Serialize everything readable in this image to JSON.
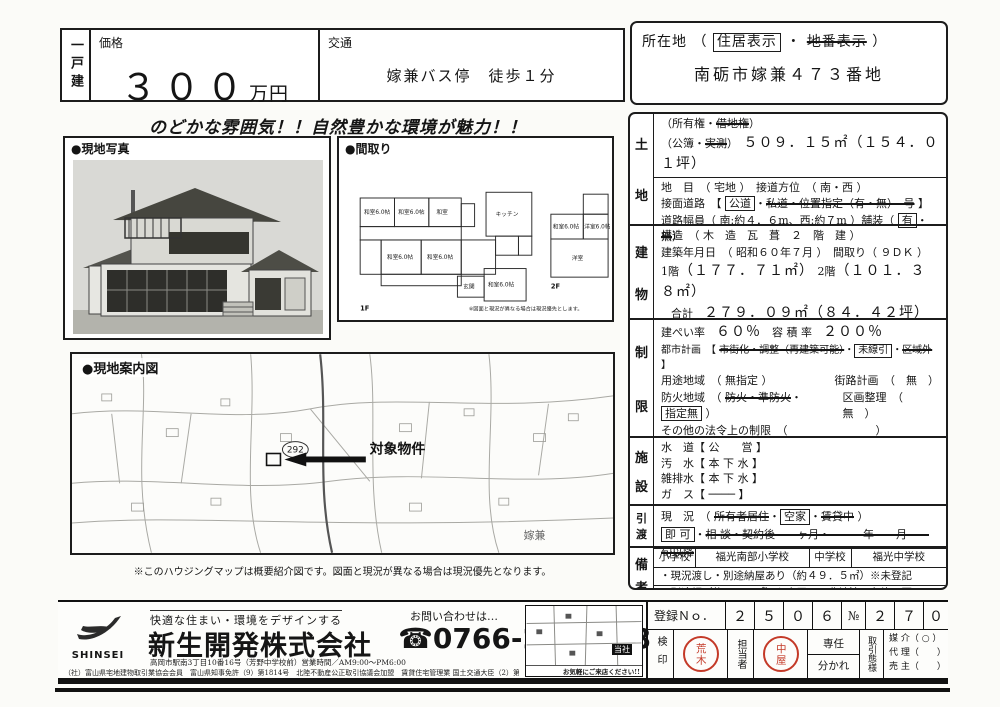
{
  "header": {
    "category": "一戸建",
    "price": {
      "label": "価格",
      "value": "３００",
      "unit": "万円"
    },
    "transport": {
      "label": "交通",
      "value": "嫁兼バス停　徒歩１分"
    },
    "location": {
      "label": "所在地",
      "paren_open": "（",
      "opt_boxed": "住居表示",
      "dot": "・",
      "opt_struck": "地番表示",
      "paren_close": "）",
      "address": "南砺市嫁兼４７３番地"
    }
  },
  "catchphrase": "のどかな雰囲気！！自然豊かな環境が魅力！！",
  "photo": {
    "label": "●現地写真"
  },
  "floorplan": {
    "label": "●間取り",
    "floor1": "1F",
    "floor2": "2F",
    "rooms1": [
      "和室6.0帖",
      "和室6.0帖",
      "和室",
      "キッチン",
      "和室6.0帖",
      "和室6.0帖",
      "玄関",
      "和室6.0帖"
    ],
    "rooms2": [
      "和室6.0帖",
      "洋室6.0帖",
      "洋室"
    ],
    "note": "※図面と現況が異なる場合は現況優先とします。"
  },
  "map": {
    "label": "●現地案内図",
    "route_badge": "292",
    "target_label": "対象物件",
    "area_label": "嫁兼",
    "note": "※このハウジングマップは概要紹介図です。図面と現況が異なる場合は現況優先となります。"
  },
  "land": {
    "h1": "土",
    "h2": "地",
    "ownership_pre": "（所有権・",
    "ownership_struck": "借地権",
    "ownership_post": "）",
    "area_pre": "（公簿・",
    "area_struck": "実測",
    "area_post": "）",
    "area_value": "５０９．１５㎡（１５４．０１坪）",
    "chimoku": "地　目　（ 宅地 ）",
    "setsudo": "接道方位　（ 南・西 ）",
    "road_label": "接面道路　【",
    "road_boxed": "公道",
    "road_dot": "・",
    "road_struck": "私道・位置指定（有・無）　号",
    "road_close": "】",
    "width_pre": "道路幅員（ 南:約４．６m、西:約７m ）舗装（",
    "width_boxed": "有",
    "width_dot": "・",
    "width_struck": "無",
    "width_close": "）"
  },
  "building": {
    "h1": "建",
    "h2": "物",
    "structure": "構造　（ 木　造　瓦　葺　２　階　建 ）",
    "built": "建築年月日　（ 昭和６０年７月 ）　間取り（ ９ＤＫ ）",
    "f1_label": "1階",
    "f1": "（１７７．７１㎡）",
    "f2_label": "2階",
    "f2": "（１０１．３８㎡）",
    "total_label": "合計",
    "total": "２７９．０９㎡（８４．４２坪）"
  },
  "restrictions": {
    "h1": "制",
    "h2": "限",
    "kenpei_label": "建ぺい率",
    "kenpei": "６０％",
    "yoseki_label": "容 積 率",
    "yoseki": "２００％",
    "city_label": "都市計画　【",
    "city_struck1": "市街化・調整（再建築可能）",
    "city_dot1": "・",
    "city_boxed": "未線引",
    "city_dot2": "・",
    "city_struck2": "区域外",
    "city_close": "】",
    "youto": "用途地域　（ 無指定 ）",
    "gairo": "街路計画　（　無　）",
    "bouka_pre": "防火地域　（",
    "bouka_struck": "防火・準防火",
    "bouka_dot": "・",
    "bouka_boxed": "指定無",
    "bouka_close": "）",
    "kukaku": "区画整理　（　無　）",
    "sonota": "その他の法令上の制限　（　　　　　　　　）"
  },
  "facilities": {
    "h1": "施",
    "h2": "設",
    "water": "水　道【 公　　営 】",
    "sewage": "汚　水【 本 下 水 】",
    "drain": "雑排水【 本 下 水 】",
    "gas": "ガ　ス【 ──── 】"
  },
  "handover": {
    "h1": "引",
    "h2": "渡",
    "genkyo_pre": "現　況　（",
    "genkyo_struck1": "所有者居住",
    "dot1": "・",
    "genkyo_boxed": "空家",
    "dot2": "・",
    "genkyo_struck2": "賃貸中",
    "genkyo_close": "）",
    "timing_boxed": "即 可",
    "timing_dot": "・",
    "timing_struck": "相 談・契約後　　ヶ月・　　　年　　月　　旬以降"
  },
  "remarks": {
    "h1": "備",
    "h2": "考",
    "elem_label": "小学校",
    "elem": "福光南部小学校",
    "jhs_label": "中学校",
    "jhs": "福光中学校",
    "note1": "・現況渡し・別途納屋あり（約４９．５㎡）※未登記",
    "note2": "・別途畑（約１５０㎡）も売買可※農地法３条許可要"
  },
  "footer": {
    "logo": "SHINSEI",
    "tagline": "快適な住まい・環境をデザインする",
    "company": "新生開発株式会社",
    "office": "高岡市駅南3丁目10番16号（芳野中学校前）営業時間／AM9:00～PM6:00",
    "contact": "お問い合わせは…",
    "phone_icon": "☎",
    "phone": "0766-24-8588",
    "tiny": "（社）富山県宅地建物取引業協会会員　富山県知事免許（9）第1814号　北陸不動産公正取引協議会加盟　賃貸住宅管理業 国土交通大臣（2）第9250号　（社）富山県住宅宅地協議会員",
    "minimap_company": "当社",
    "minimap_note": "お気軽にご来店ください!!",
    "reg": {
      "label": "登録Ｎｏ．",
      "digits": [
        "２",
        "５",
        "０",
        "６"
      ],
      "no_label": "№",
      "digits2": [
        "２",
        "７",
        "０"
      ]
    },
    "kenin_label": "検印",
    "kenin_stamp": "荒木",
    "tanto_label": "担当者",
    "tanto_stamp": "中屋",
    "sennin": "専任",
    "wakare": "分かれ",
    "taiyo_label": "取引態様",
    "baikai": "媒 介（ ○ ）",
    "dairi": "代 理（　　）",
    "urinushi": "売 主（　　）"
  }
}
